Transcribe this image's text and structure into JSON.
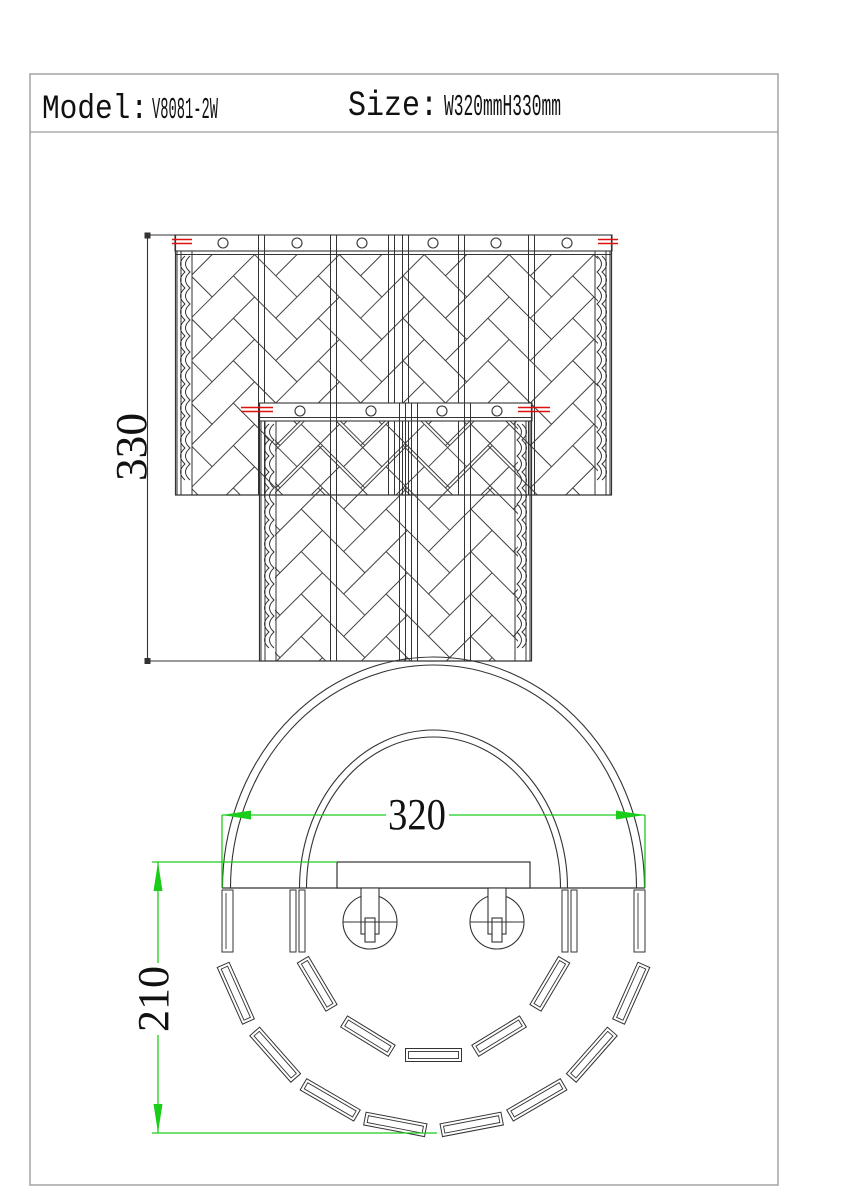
{
  "colors": {
    "paper": "#ffffff",
    "border": "#9c9c9c",
    "ink": "#333333",
    "pattern_ink": "#3b3b3b",
    "red": "#dd1111",
    "green": "#1bcd1b",
    "text": "#111111"
  },
  "title_block": {
    "model_label": "Model:",
    "model_value": "V8081-2W",
    "size_label": "Size:",
    "size_value": "W320mmH330mm"
  },
  "front_view": {
    "height_dim": "330",
    "upper_panel_circles_x": [
      223,
      297,
      362,
      433,
      496,
      567
    ],
    "upper_divider_x": [
      258,
      330,
      388,
      402,
      458,
      528
    ],
    "circle_y_upper": 243,
    "lower_panel_circles_x": [
      300,
      371,
      442,
      497
    ],
    "lower_divider_x": [
      330,
      399,
      411,
      464
    ],
    "circle_y_lower": 411
  },
  "bottom_view": {
    "width_dim": "320",
    "depth_dim": "210",
    "outer_crystal_angles_deg": [
      26,
      44,
      62,
      80,
      100,
      118,
      136,
      154
    ],
    "inner_crystal_angles_deg": [
      35,
      62.5,
      90,
      117.5,
      145
    ]
  }
}
